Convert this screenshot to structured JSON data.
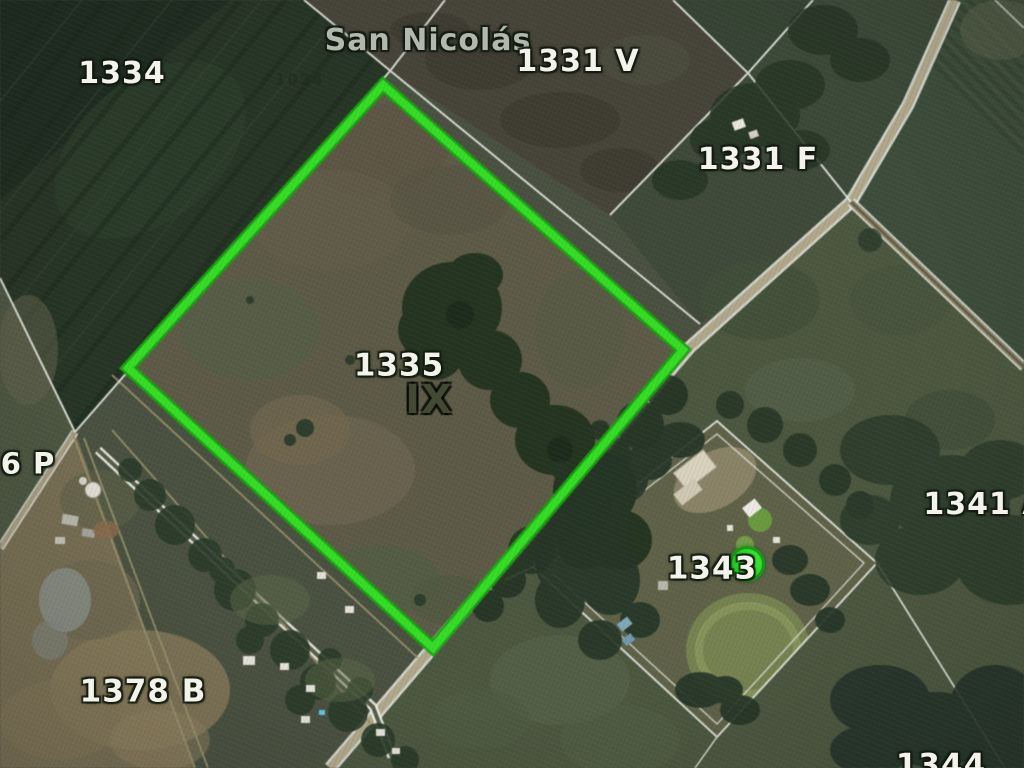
{
  "title": "Satellite parcel map",
  "map": {
    "locality": "San Nicolás",
    "highlighted_parcel": {
      "id": "1335",
      "zone": "IX"
    },
    "labels": [
      {
        "name": "locality-san-nicolas",
        "text": "San Nicolás",
        "x": 428,
        "y": 41,
        "style": "place",
        "size": 30
      },
      {
        "name": "parcel-1334",
        "text": "1334",
        "x": 122,
        "y": 74,
        "style": "light",
        "size": 30
      },
      {
        "name": "parcel-1331-v",
        "text": "1331 V",
        "x": 578,
        "y": 62,
        "style": "light",
        "size": 30
      },
      {
        "name": "parcel-1331-f",
        "text": "1331 F",
        "x": 758,
        "y": 160,
        "style": "light",
        "size": 30
      },
      {
        "name": "parcel-1335",
        "text": "1335",
        "x": 399,
        "y": 366,
        "style": "light",
        "size": 31
      },
      {
        "name": "parcel-1335-zone",
        "text": "IX",
        "x": 429,
        "y": 400,
        "style": "dark",
        "size": 40
      },
      {
        "name": "parcel-6-p",
        "text": "6 P",
        "x": 28,
        "y": 464,
        "style": "light",
        "size": 29
      },
      {
        "name": "parcel-1341-a",
        "text": "1341 A",
        "x": 985,
        "y": 505,
        "style": "light",
        "size": 30
      },
      {
        "name": "parcel-1343",
        "text": "1343",
        "x": 712,
        "y": 569,
        "style": "light",
        "size": 31
      },
      {
        "name": "parcel-1378-b",
        "text": "1378 B",
        "x": 143,
        "y": 692,
        "style": "light",
        "size": 31
      },
      {
        "name": "parcel-1344",
        "text": "1344",
        "x": 941,
        "y": 766,
        "style": "light",
        "size": 31
      },
      {
        "name": "watermark-1024",
        "text": "1024",
        "x": 300,
        "y": 80,
        "style": "faint",
        "size": 15
      }
    ],
    "marker": {
      "name": "parcel-1343-marker",
      "label_for": "1343",
      "x": 747,
      "y": 564,
      "radius": 15,
      "fill": "#2bd62a",
      "ring": "#149d12"
    },
    "highlight": {
      "parcel": "1335",
      "points": "383,85 683,350 433,648 128,368",
      "color": "#2fe01f",
      "edge_color": "#17a30e"
    }
  }
}
